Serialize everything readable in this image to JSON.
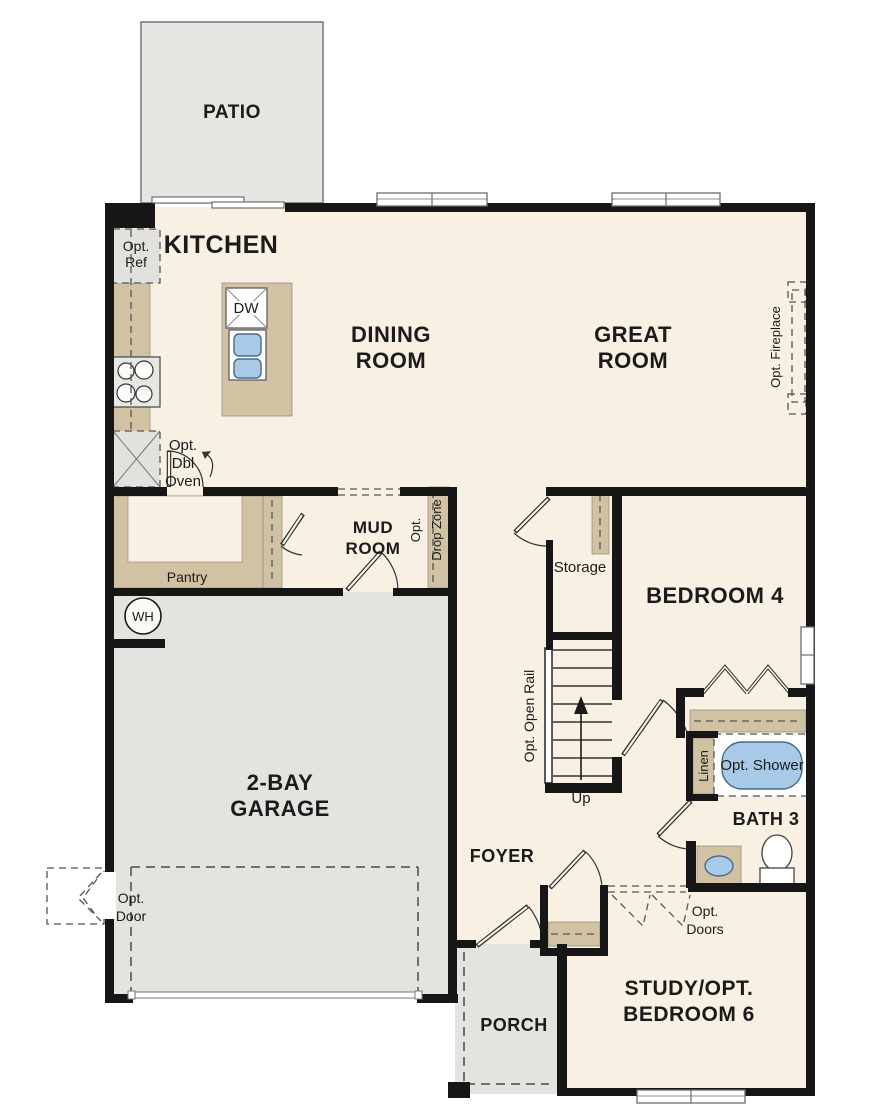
{
  "plan_title": "First floor residential floor plan",
  "colors": {
    "floor": "#f8f0e3",
    "concrete": "#e4e3e0",
    "cabinet_tan": "#d2c2a4",
    "wall": "#161616",
    "water_blue": "#a9c9e9"
  },
  "rooms": {
    "patio": {
      "label": "PATIO"
    },
    "kitchen": {
      "label": "KITCHEN"
    },
    "dining": {
      "line1": "DINING",
      "line2": "ROOM"
    },
    "great": {
      "line1": "GREAT",
      "line2": "ROOM"
    },
    "mud": {
      "line1": "MUD",
      "line2": "ROOM"
    },
    "storage": {
      "label": "Storage"
    },
    "bedroom4": {
      "label": "BEDROOM 4"
    },
    "pantry": {
      "label": "Pantry"
    },
    "garage": {
      "line1": "2-BAY",
      "line2": "GARAGE"
    },
    "foyer": {
      "label": "FOYER"
    },
    "bath3": {
      "label": "BATH 3"
    },
    "porch": {
      "label": "PORCH"
    },
    "study": {
      "line1": "STUDY/OPT.",
      "line2": "BEDROOM 6"
    }
  },
  "annotations": {
    "opt_ref": {
      "line1": "Opt.",
      "line2": "Ref"
    },
    "dishwasher": {
      "label": "DW"
    },
    "opt_dbl_oven": {
      "line1": "Opt.",
      "line2": "Dbl",
      "line3": "Oven"
    },
    "water_heater": {
      "label": "WH"
    },
    "opt_drop_zone": {
      "line1": "Opt.",
      "line2": "Drop Zone"
    },
    "opt_fireplace": {
      "label": "Opt. Fireplace"
    },
    "opt_open_rail": {
      "label": "Opt. Open Rail"
    },
    "up": {
      "label": "Up"
    },
    "opt_door": {
      "line1": "Opt.",
      "line2": "Door"
    },
    "linen": {
      "label": "Linen"
    },
    "opt_shower": {
      "label": "Opt. Shower"
    },
    "opt_doors": {
      "line1": "Opt.",
      "line2": "Doors"
    }
  }
}
